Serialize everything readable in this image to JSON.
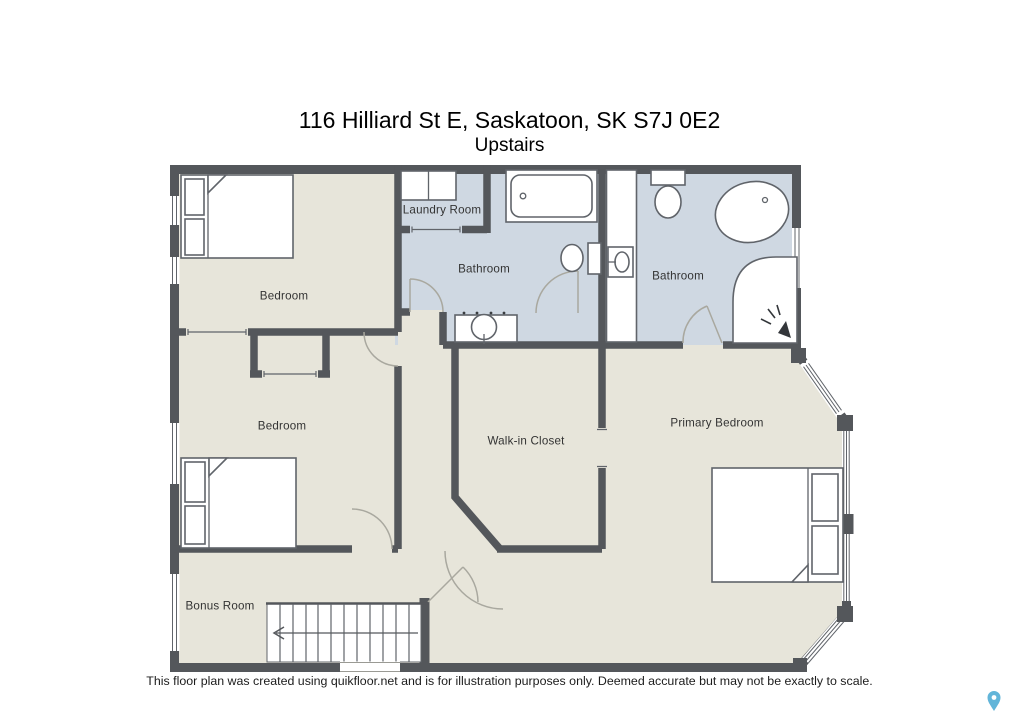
{
  "header": {
    "title": "116 Hilliard St E, Saskatoon, SK S7J 0E2",
    "subtitle": "Upstairs"
  },
  "rooms": {
    "bedroom_top": {
      "label": "Bedroom"
    },
    "laundry": {
      "label": "Laundry Room"
    },
    "bathroom_main": {
      "label": "Bathroom"
    },
    "bathroom_ensuite": {
      "label": "Bathroom"
    },
    "bedroom_middle": {
      "label": "Bedroom"
    },
    "walk_in_closet": {
      "label": "Walk-in Closet"
    },
    "primary_bedroom": {
      "label": "Primary Bedroom"
    },
    "bonus_room": {
      "label": "Bonus Room"
    }
  },
  "footer": {
    "disclaimer": "This floor plan was created using quikfloor.net and is for illustration purposes only. Deemed accurate but may not be exactly to scale."
  },
  "icons": {
    "map_pin": "map-pin-icon",
    "stairs": "stairs-icon"
  },
  "colors": {
    "wall": "#54575b",
    "floor": "#e7e5da",
    "bathroom_floor": "#cfd8e2",
    "fixture_outline": "#60646a",
    "door_arc": "#a9a89f",
    "map_pin": "#62b5d9",
    "text": "#333333"
  }
}
